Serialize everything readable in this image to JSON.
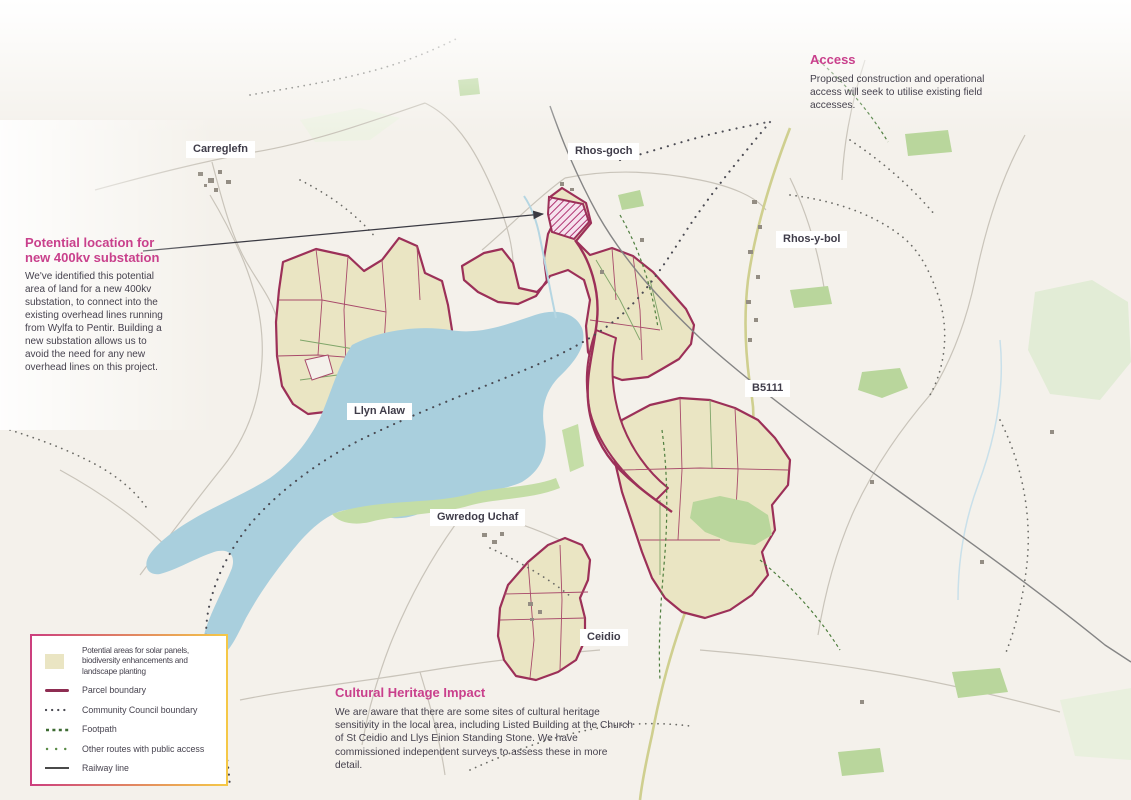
{
  "annotations": {
    "access": {
      "title": "Access",
      "body": "Proposed construction and operational access will seek to utilise existing field accesses."
    },
    "substation": {
      "title": "Potential location for new 400kv substation",
      "body": "We've identified this potential area of land for a new 400kv substation, to connect into the existing overhead lines running from Wylfa to Pentir. Building a new substation allows us to avoid the need for any new overhead lines on this project."
    },
    "heritage": {
      "title": "Cultural Heritage Impact",
      "body": "We are aware that there are some sites of cultural heritage sensitivity in the local area, including Listed Building at the Church of St Ceidio and Llys Einion Standing Stone. We have commissioned independent surveys to assess these in more detail."
    }
  },
  "map_labels": [
    {
      "text": "Carreglefn"
    },
    {
      "text": "Rhos-goch"
    },
    {
      "text": "Rhos-y-bol"
    },
    {
      "text": "B5111"
    },
    {
      "text": "Llyn Alaw"
    },
    {
      "text": "Gwredog Uchaf"
    },
    {
      "text": "Ceidio"
    }
  ],
  "legend": {
    "items": [
      {
        "icon": "solar-area-swatch",
        "label": "Potential areas for solar panels, biodiversity enhancements and landscape planting"
      },
      {
        "icon": "parcel-boundary-line",
        "label": "Parcel boundary"
      },
      {
        "icon": "community-council-boundary-dots",
        "label": "Community Council boundary"
      },
      {
        "icon": "footpath-dashes",
        "label": "Footpath"
      },
      {
        "icon": "public-access-route-dots",
        "label": "Other routes with public access"
      },
      {
        "icon": "railway-line",
        "label": "Railway line"
      }
    ]
  },
  "colors": {
    "accent_pink": "#c9408c",
    "parcel_fill": "#eae5c3",
    "parcel_boundary": "#9c3058",
    "lake_blue": "#a9cfdd",
    "map_background": "#f4f1eb",
    "legend_border_left": "#cc3f7e",
    "legend_border_right": "#f5c847",
    "body_text": "#46424e",
    "railway_gray": "#858585",
    "footpath_green": "#4e7e3e"
  }
}
